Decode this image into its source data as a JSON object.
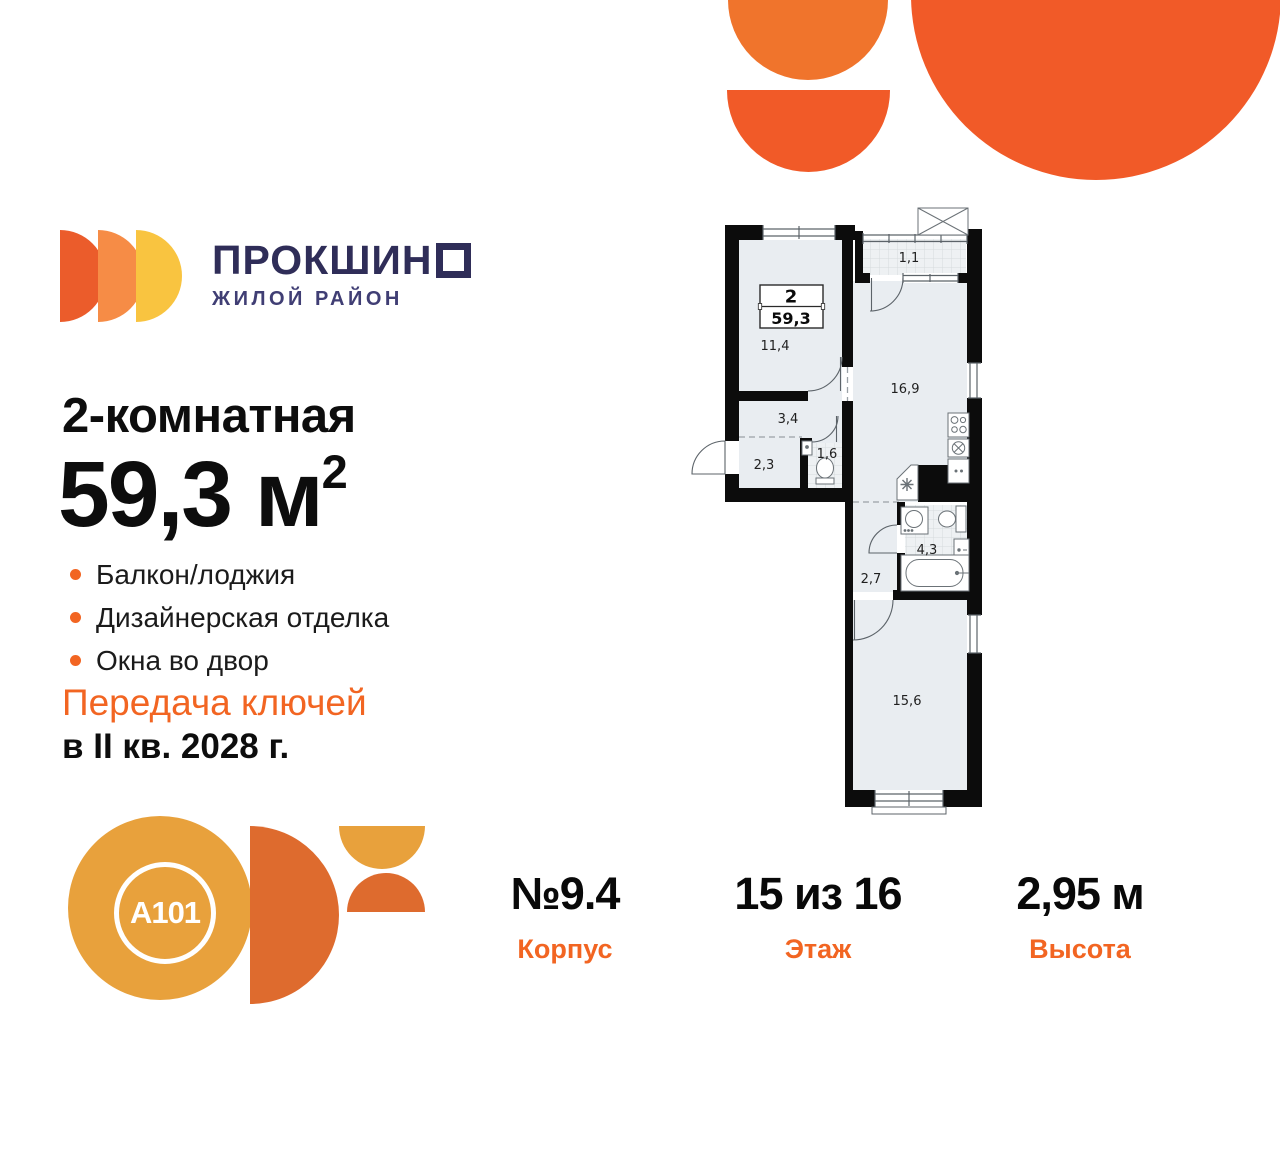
{
  "brand": {
    "name_prefix": "ПРОКШИН",
    "name_last_letter": "О",
    "subtitle": "ЖИЛОЙ РАЙОН"
  },
  "listing": {
    "title": "2-комнатная",
    "area_value": "59,3",
    "area_unit": "м",
    "area_sup": "2",
    "features": [
      "Балкон/лоджия",
      "Дизайнерская отделка",
      "Окна во двор"
    ],
    "keys_line1": "Передача ключей",
    "keys_line2": "в II кв. 2028 г."
  },
  "plan": {
    "badge": {
      "rooms": "2",
      "area": "59,3"
    },
    "room_labels": {
      "balcony": "1,1",
      "bedroom1": "11,4",
      "hall": "3,4",
      "entry": "2,3",
      "wc": "1,6",
      "kitchen": "16,9",
      "bathroom": "4,3",
      "corridor": "2,7",
      "bedroom2": "15,6"
    }
  },
  "stats": [
    {
      "value": "№9.4",
      "label": "Корпус"
    },
    {
      "value": "15 из 16",
      "label": "Этаж"
    },
    {
      "value": "2,95 м",
      "label": "Высота"
    }
  ],
  "developer": {
    "logo_text": "A101"
  },
  "colors": {
    "accent": "#F26522",
    "navy": "#2F2D58",
    "navy2": "#403E74",
    "deco-orange": "#F15A28",
    "deco-orange-light": "#F0742C",
    "gold": "#E8A13C",
    "dkorange": "#DE6B2E",
    "ink": "#0d0d0d"
  }
}
